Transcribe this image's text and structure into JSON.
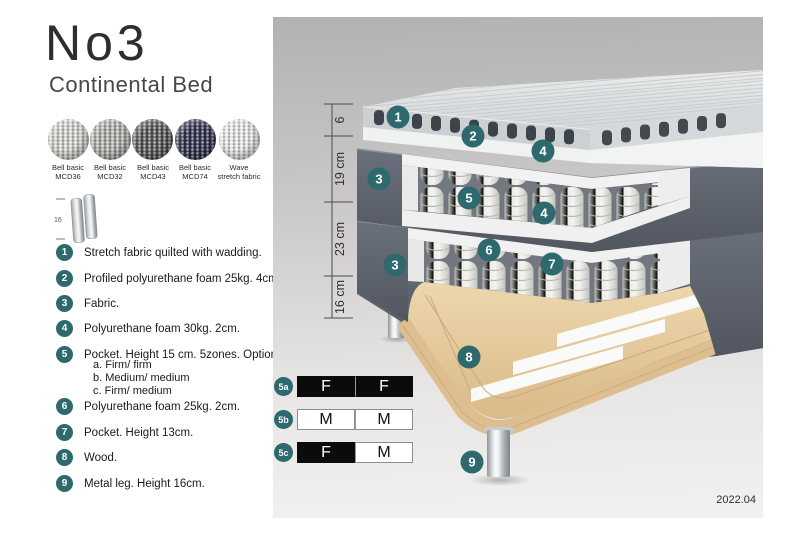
{
  "header": {
    "title": "No3",
    "subtitle": "Continental Bed"
  },
  "fabric_swatches": [
    {
      "line1": "Bell basic",
      "line2": "MCD36",
      "color": "#d9d6d0"
    },
    {
      "line1": "Bell basic",
      "line2": "MCD32",
      "color": "#b3b1ad"
    },
    {
      "line1": "Bell basic",
      "line2": "MCD43",
      "color": "#5a5856"
    },
    {
      "line1": "Bell basic",
      "line2": "MCD74",
      "color": "#31344f"
    },
    {
      "line1": "Wave",
      "line2": "stretch fabric",
      "color": "#eaeaea"
    }
  ],
  "leg_thumbnail": {
    "height_label": "16"
  },
  "spec_list": [
    {
      "num": "1",
      "text": "Stretch fabric quilted with wadding."
    },
    {
      "num": "2",
      "text": "Profiled polyurethane foam 25kg. 4cm."
    },
    {
      "num": "3",
      "text": "Fabric."
    },
    {
      "num": "4",
      "text": "Polyurethane foam 30kg. 2cm."
    },
    {
      "num": "5",
      "text": "Pocket. Height 15 cm. 5zones. Option:",
      "options": [
        "a. Firm/ firm",
        "b. Medium/ medium",
        "c. Firm/ medium"
      ]
    },
    {
      "num": "6",
      "text": "Polyurethane foam 25kg. 2cm."
    },
    {
      "num": "7",
      "text": "Pocket. Height 13cm."
    },
    {
      "num": "8",
      "text": "Wood."
    },
    {
      "num": "9",
      "text": "Metal leg. Height 16cm."
    }
  ],
  "diagram": {
    "dimension_labels": [
      "6",
      "19 cm",
      "23 cm",
      "16 cm"
    ],
    "badges": [
      "1",
      "2",
      "4",
      "3",
      "5",
      "4",
      "6",
      "7",
      "3",
      "8",
      "9"
    ],
    "version": "2022.04"
  },
  "firmness_table": {
    "rows": [
      {
        "id": "5a",
        "cells": [
          {
            "label": "F",
            "variant": "dark"
          },
          {
            "label": "F",
            "variant": "dark"
          }
        ]
      },
      {
        "id": "5b",
        "cells": [
          {
            "label": "M",
            "variant": "light"
          },
          {
            "label": "M",
            "variant": "light"
          }
        ]
      },
      {
        "id": "5c",
        "cells": [
          {
            "label": "F",
            "variant": "dark"
          },
          {
            "label": "M",
            "variant": "light"
          }
        ]
      }
    ]
  },
  "colors": {
    "badge_teal": "#2d696d",
    "dark_fabric": "#565c66",
    "wood": "#e6cda2",
    "firmness_black": "#0b0b0b",
    "panel_top": "#b2b2b2",
    "panel_bottom": "#f2f1ef"
  }
}
